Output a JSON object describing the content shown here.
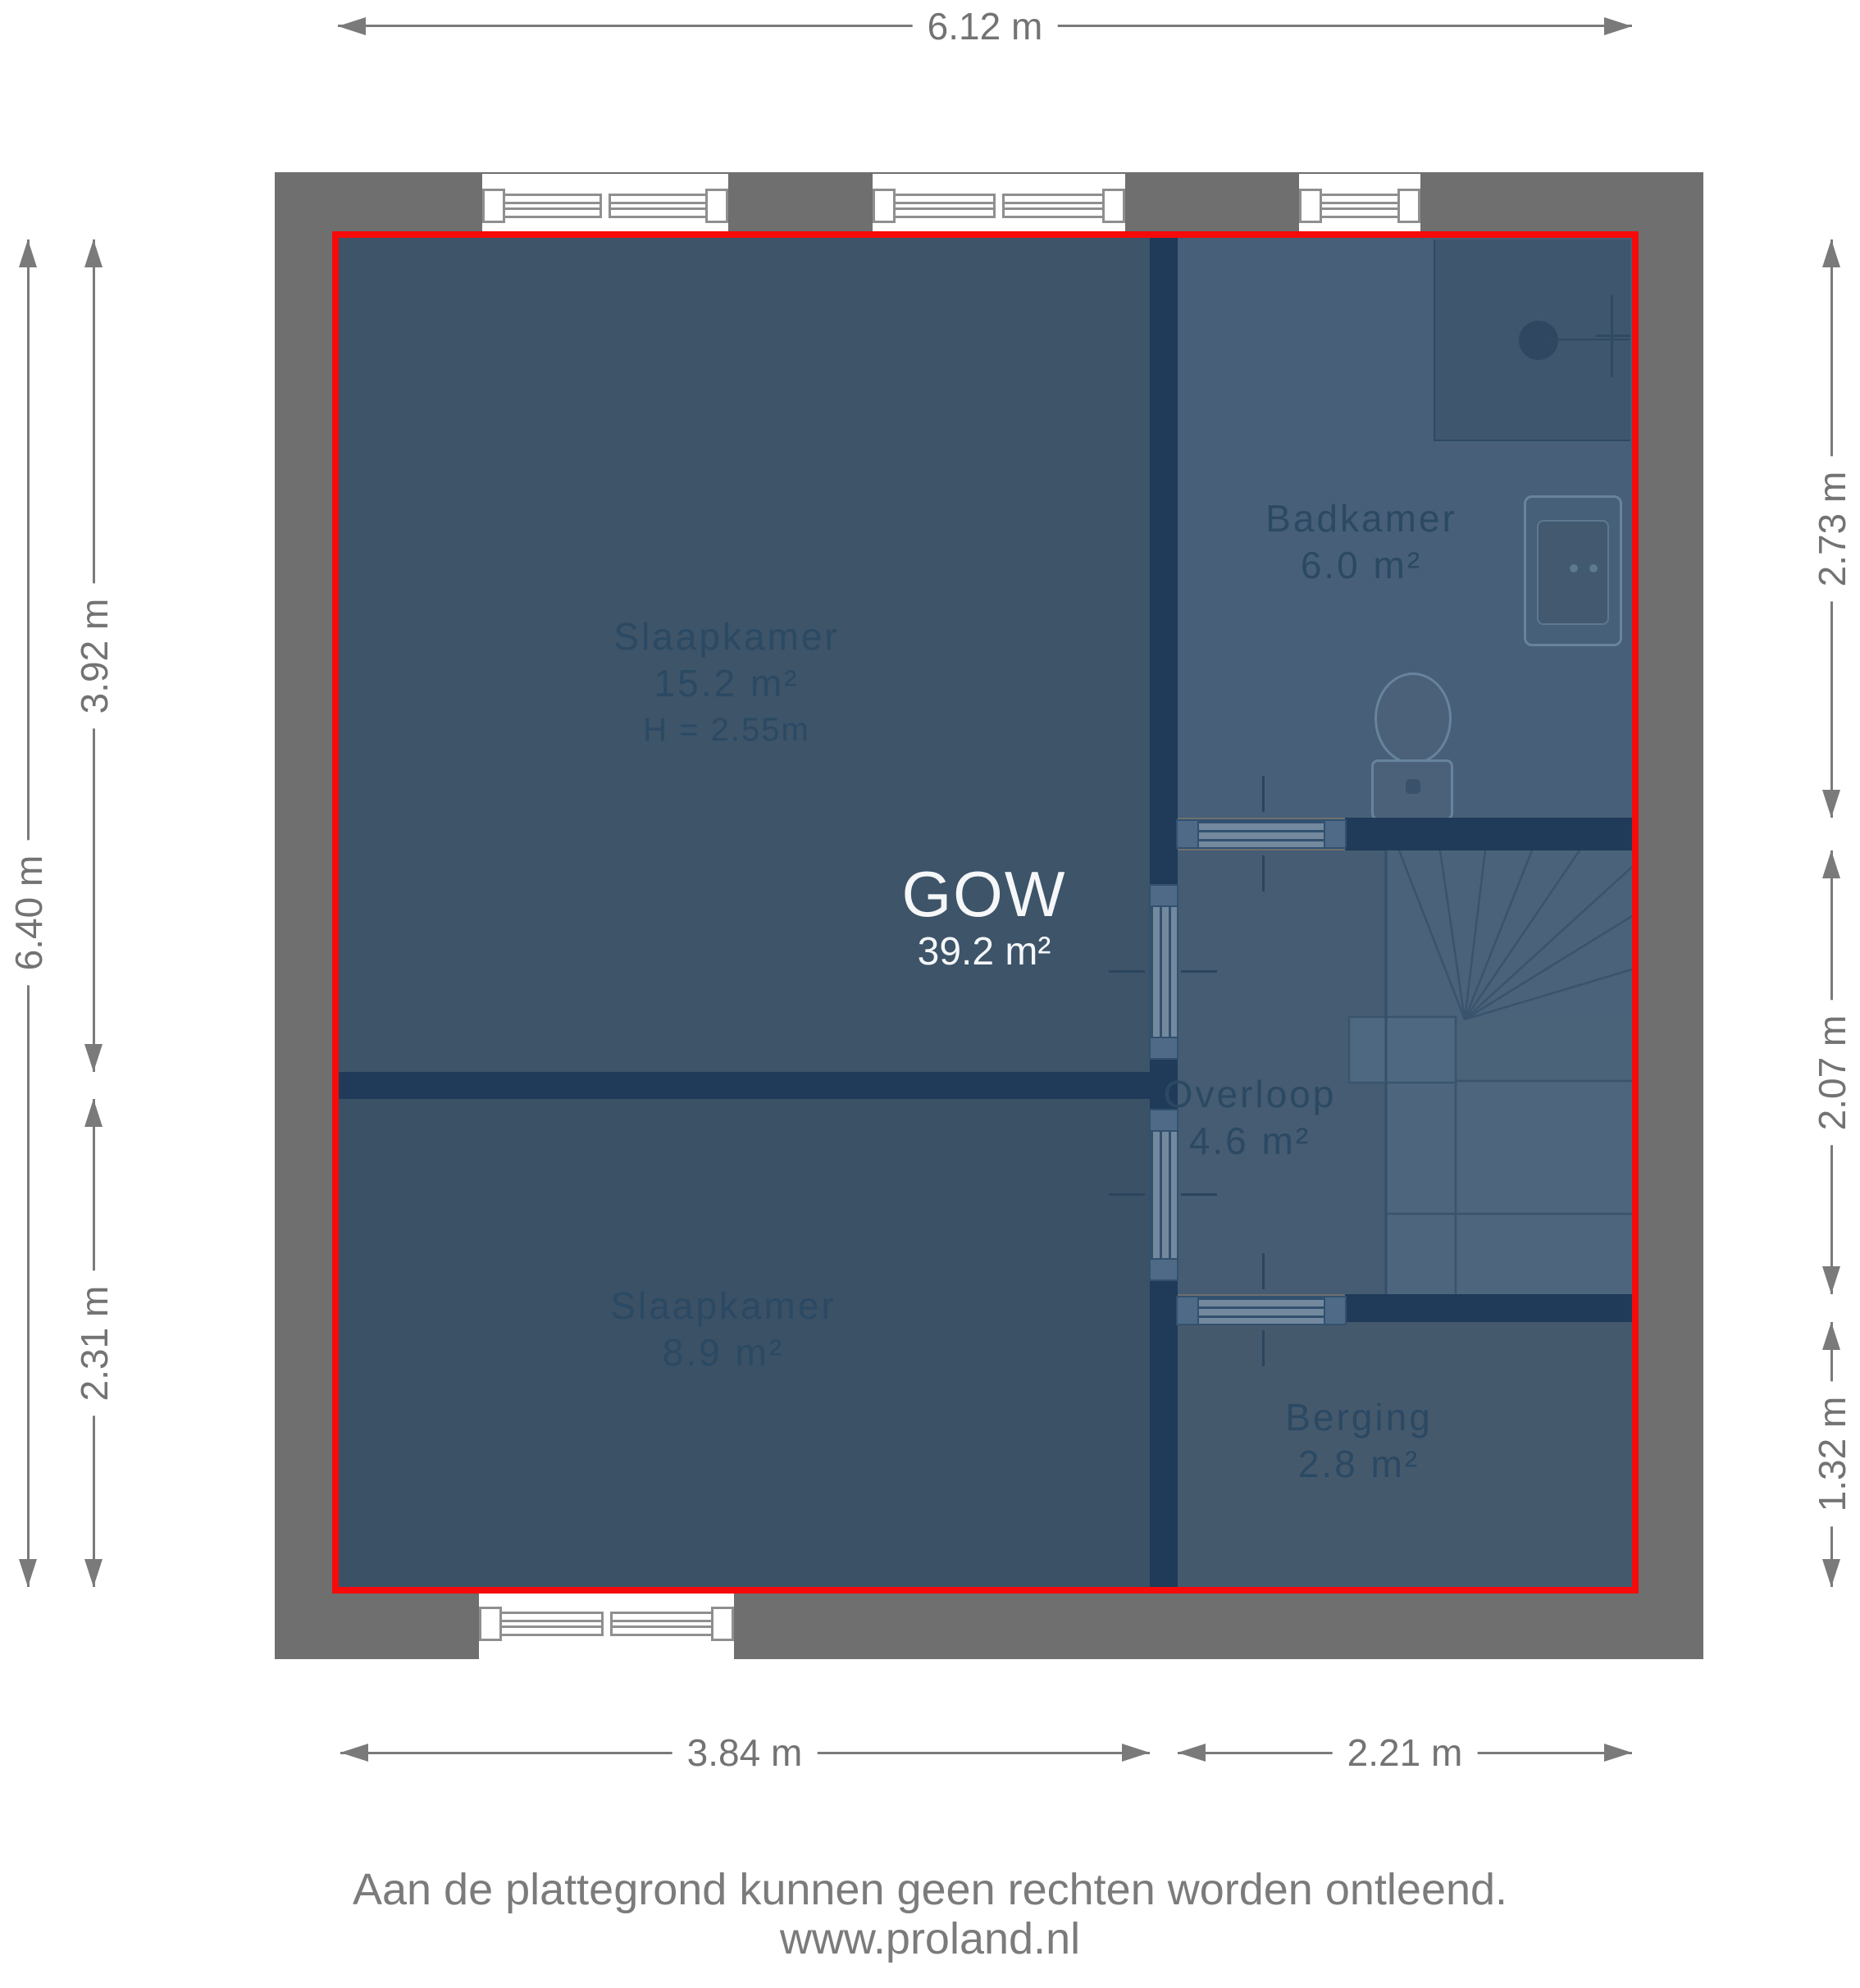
{
  "plan": {
    "overlay": {
      "label": "GOW",
      "area": "39.2 m²"
    },
    "rooms": [
      {
        "name": "Slaapkamer",
        "area": "15.2 m²",
        "ceiling_height": "H = 2.55m"
      },
      {
        "name": "Badkamer",
        "area": "6.0 m²"
      },
      {
        "name": "Overloop",
        "area": "4.6 m²"
      },
      {
        "name": "Slaapkamer",
        "area": "8.9 m²"
      },
      {
        "name": "Berging",
        "area": "2.8 m²"
      }
    ],
    "symbols": [
      "window",
      "door",
      "staircase",
      "shower",
      "toilet",
      "sink"
    ]
  },
  "dimensions": {
    "top_width": "6.12 m",
    "left_total_height": "6.40 m",
    "left_upper_height": "3.92 m",
    "left_lower_height": "2.31 m",
    "right_upper_height": "2.73 m",
    "right_middle_height": "2.07 m",
    "right_lower_height": "1.32 m",
    "bottom_left_width": "3.84 m",
    "bottom_right_width": "2.21 m"
  },
  "footer": {
    "disclaimer": "Aan de plattegrond kunnen geen rechten worden ontleend.",
    "website": "www.proland.nl"
  },
  "colors": {
    "outline_accent": "#ff0000",
    "exterior_wall": "#6f6f6f",
    "interior_wall": "#1f3b59",
    "room_fill_dark": "#3d5469",
    "room_fill_light": "#475f78",
    "dimension_text": "#737373",
    "room_label_text": "#2b4963",
    "overlay_text": "#f5f7f8"
  }
}
